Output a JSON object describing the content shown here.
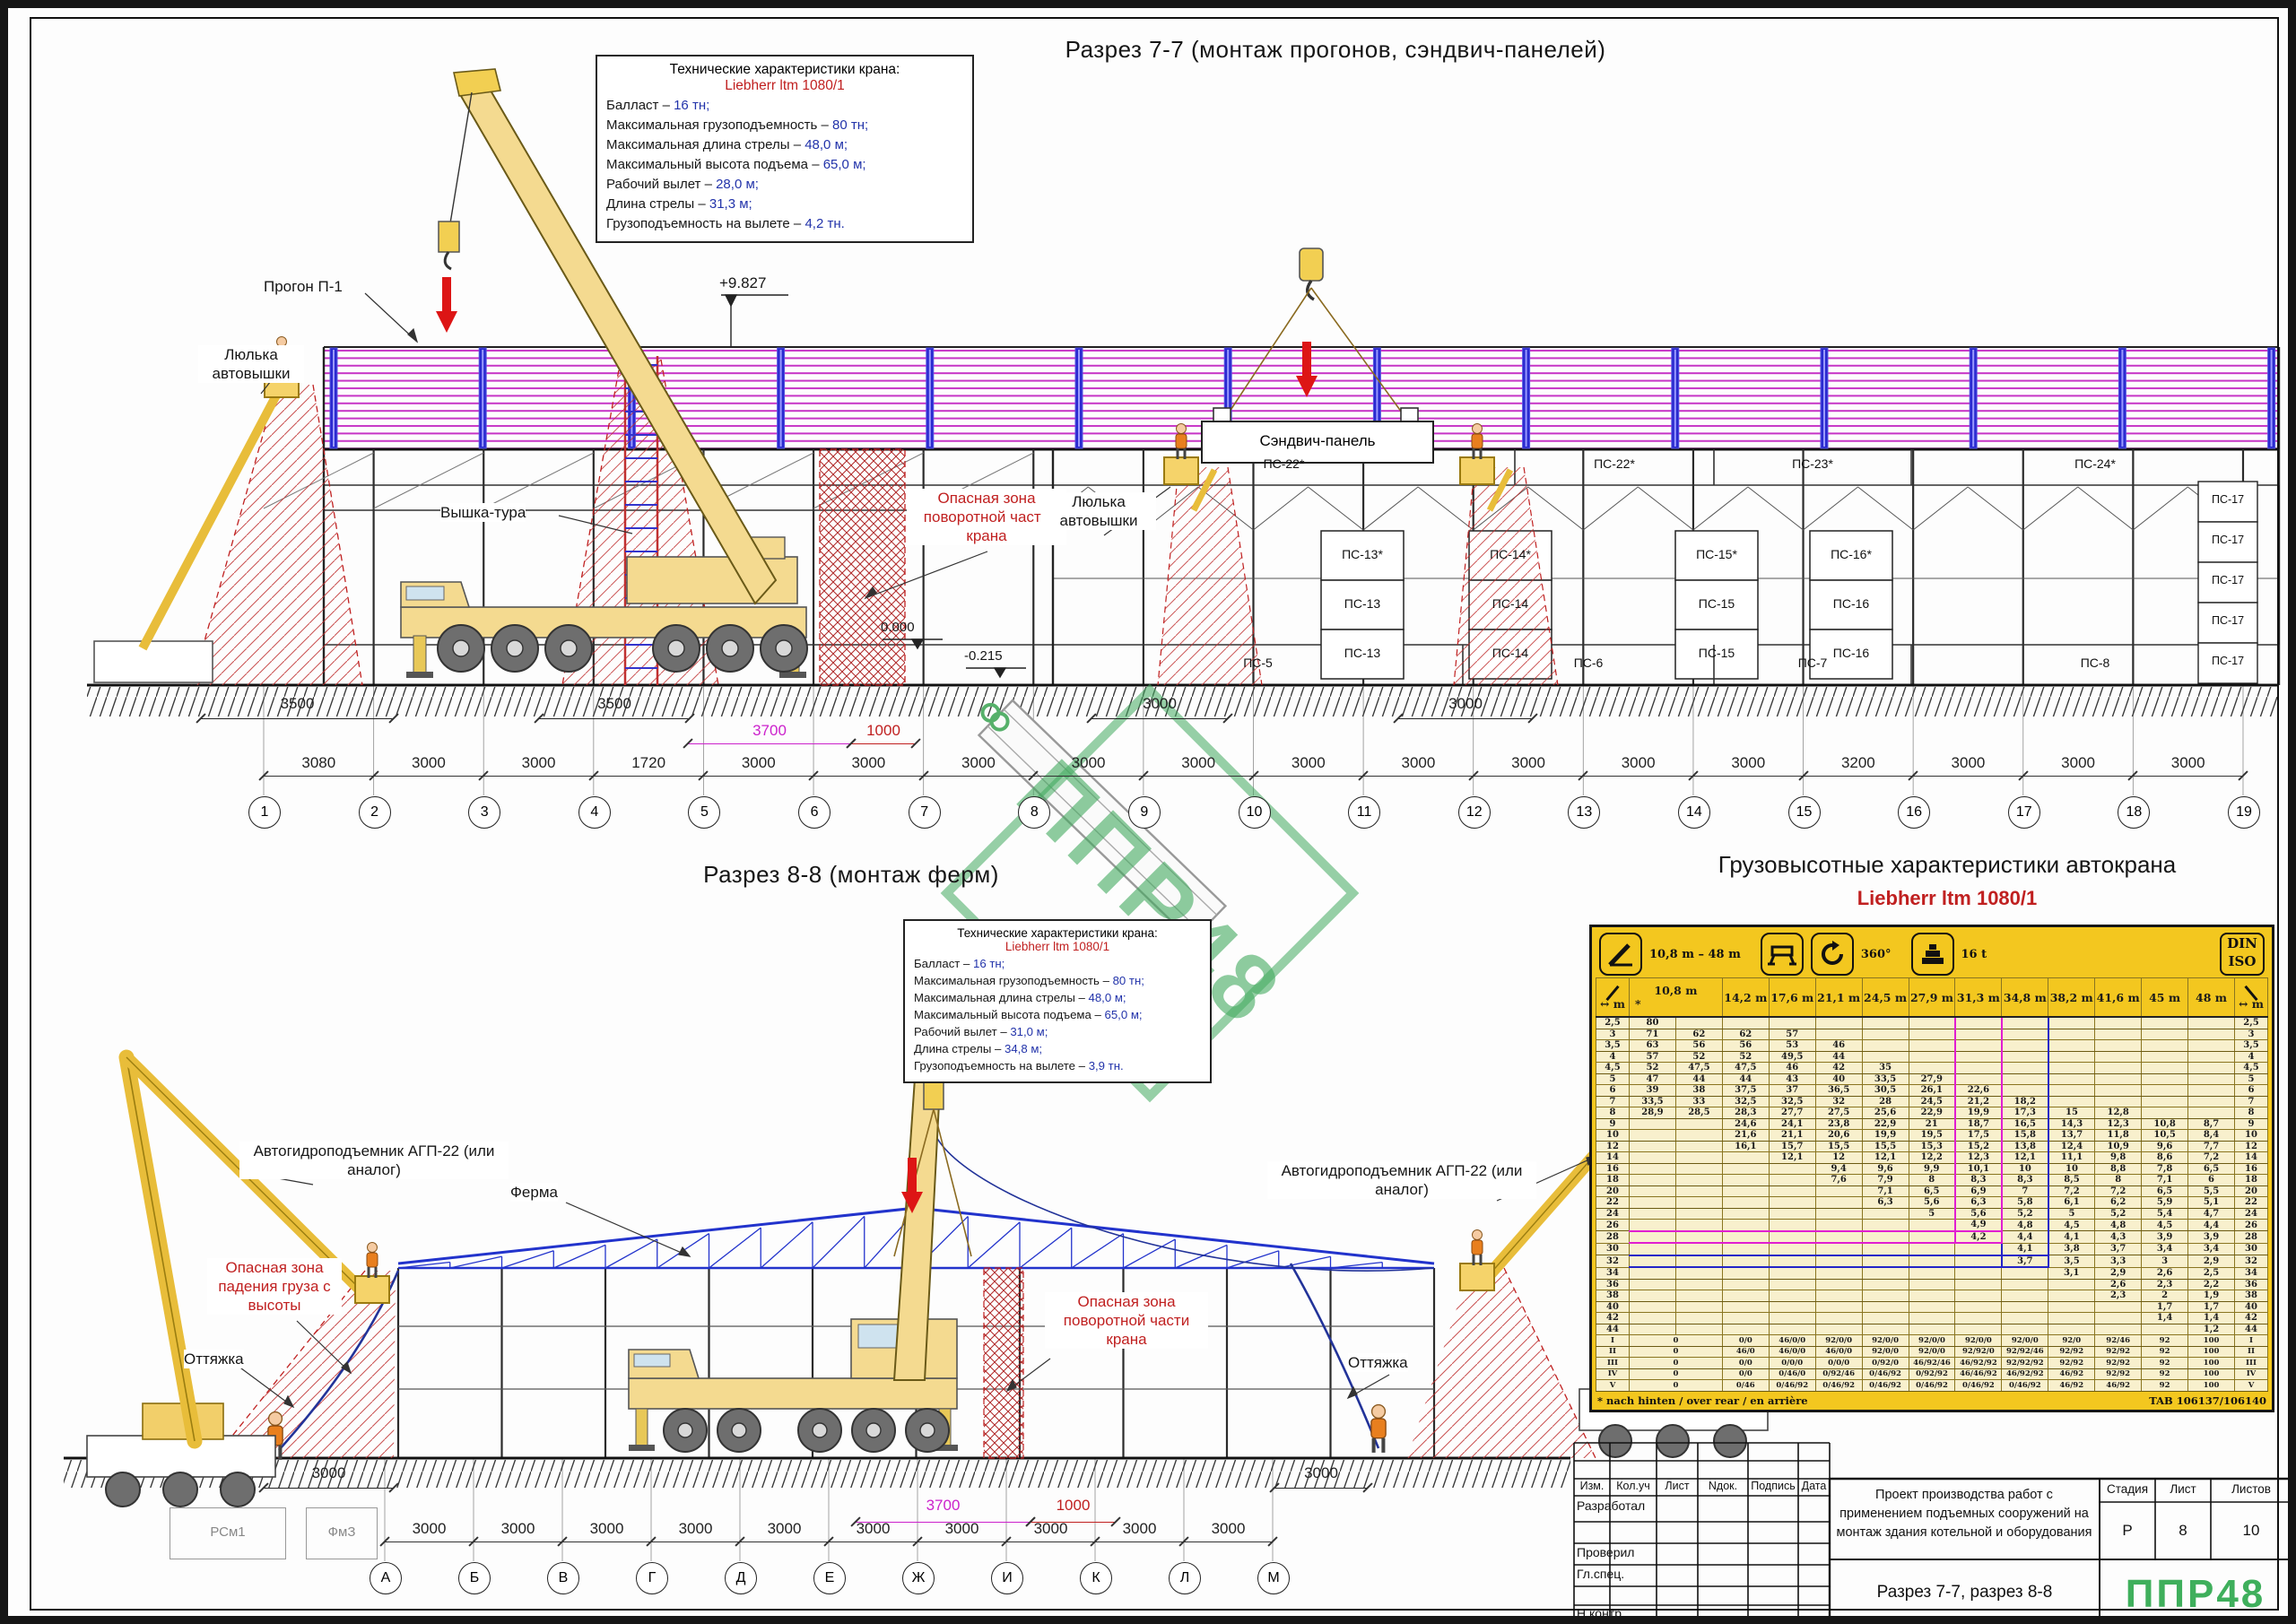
{
  "sheet": {
    "watermark": "ППР48",
    "colors": {
      "danger_red": "#c02020",
      "dim_magenta": "#cc22cc",
      "value_blue": "#2233aa",
      "panel_magenta": "#cc22cc",
      "truss_blue": "#2233cc",
      "table_yellow": "#f3c71f",
      "logo_green": "#3faf5c",
      "crane_yellow": "#f4da90"
    }
  },
  "section77": {
    "title": "Разрез 7-7 (монтаж прогонов, сэндвич-панелей)",
    "specs": {
      "heading": "Технические характеристики крана:",
      "crane_name": "Liebherr ltm 1080/1",
      "items": [
        {
          "label": "Балласт – ",
          "value": "16 тн;"
        },
        {
          "label": "Максимальная грузоподъемность – ",
          "value": "80 тн;"
        },
        {
          "label": "Максимальная длина стрелы – ",
          "value": "48,0 м;"
        },
        {
          "label": "Максимальный высота подъема – ",
          "value": "65,0 м;"
        },
        {
          "label": "Рабочий вылет – ",
          "value": "28,0 м;"
        },
        {
          "label": "Длина стрелы – ",
          "value": "31,3 м;"
        },
        {
          "label": "Грузоподъемность на вылете – ",
          "value": "4,2 тн."
        }
      ]
    },
    "labels": {
      "progon": "Прогон П-1",
      "lyulka": "Люлька автовышки",
      "vyshka": "Вышка-тура",
      "danger_crane": "Опасная зона поворотной части крана",
      "lyulka2": "Люлька автовышки",
      "sandwich": "Сэндвич-панель",
      "elev_top": "+9.827",
      "elev_zero": "0.000",
      "elev_minus": "-0.215"
    },
    "panels": {
      "top_band": [
        "ПС-22*",
        "ПС-22*",
        "ПС-23*",
        "ПС-24*"
      ],
      "stacks": [
        [
          "ПС-13*",
          "ПС-13",
          "ПС-13"
        ],
        [
          "ПС-14*",
          "ПС-14",
          "ПС-14"
        ],
        [
          "ПС-15*",
          "ПС-15",
          "ПС-15"
        ],
        [
          "ПС-16*",
          "ПС-16",
          "ПС-16"
        ]
      ],
      "bottom_band": [
        "ПС-5",
        "ПС-6",
        "ПС-7",
        "ПС-8"
      ],
      "right_stack": [
        "ПС-17",
        "ПС-17",
        "ПС-17",
        "ПС-17",
        "ПС-17"
      ]
    },
    "upper_dims": [
      {
        "text": "3500",
        "color": "#222"
      },
      {
        "text": "3500",
        "color": "#222"
      },
      {
        "text": "3700",
        "color": "#cc22cc"
      },
      {
        "text": "1000",
        "color": "#c02020"
      },
      {
        "text": "3000",
        "color": "#222"
      },
      {
        "text": "3000",
        "color": "#222"
      }
    ],
    "chain_dims": [
      "3080",
      "3000",
      "3000",
      "1720",
      "3000",
      "3000",
      "3000",
      "3000",
      "3000",
      "3000",
      "3000",
      "3000",
      "3000",
      "3000",
      "3200",
      "3000",
      "3000",
      "3000"
    ],
    "axes": [
      "1",
      "2",
      "3",
      "4",
      "5",
      "6",
      "7",
      "8",
      "9",
      "10",
      "11",
      "12",
      "13",
      "14",
      "15",
      "16",
      "17",
      "18",
      "19"
    ]
  },
  "section88": {
    "title": "Разрез 8-8 (монтаж ферм)",
    "specs": {
      "heading": "Технические характеристики крана:",
      "crane_name": "Liebherr ltm 1080/1",
      "items": [
        {
          "label": "Балласт – ",
          "value": "16 тн;"
        },
        {
          "label": "Максимальная грузоподъемность – ",
          "value": "80 тн;"
        },
        {
          "label": "Максимальная длина стрелы – ",
          "value": "48,0 м;"
        },
        {
          "label": "Максимальный высота подъема – ",
          "value": "65,0 м;"
        },
        {
          "label": "Рабочий вылет – ",
          "value": "31,0 м;"
        },
        {
          "label": "Длина стрелы – ",
          "value": "34,8 м;"
        },
        {
          "label": "Грузоподъемность на вылете – ",
          "value": "3,9 тн."
        }
      ]
    },
    "labels": {
      "agp": "Автогидроподъемник АГП-22 (или аналог)",
      "ferma": "Ферма",
      "danger_fall": "Опасная зона падения груза с высоты",
      "danger_crane": "Опасная зона поворотной части крана",
      "ottyazhka": "Оттяжка",
      "footing1": "РСм1",
      "footing2": "ФмЗ"
    },
    "ground_dims": [
      {
        "text": "3000",
        "color": "#222"
      },
      {
        "text": "3000",
        "color": "#222"
      },
      {
        "text": "3700",
        "color": "#cc22cc"
      },
      {
        "text": "1000",
        "color": "#c02020"
      }
    ],
    "chain_dims": [
      "3000",
      "3000",
      "3000",
      "3000",
      "3000",
      "3000",
      "3000",
      "3000",
      "3000",
      "3000"
    ],
    "axes": [
      "А",
      "Б",
      "В",
      "Г",
      "Д",
      "Е",
      "Ж",
      "И",
      "К",
      "Л",
      "М"
    ]
  },
  "load_chart": {
    "title": "Грузовысотные характеристики автокрана",
    "crane_name": "Liebherr ltm 1080/1",
    "badges": {
      "boom_range": "10,8 m – 48 m",
      "slew": "360°",
      "counterweight": "16 t",
      "standard": "DIN ISO"
    },
    "icons": [
      "telescopic-boom-icon",
      "outriggers-icon",
      "rotation-360-icon",
      "counterweight-icon",
      "din-iso-badge"
    ],
    "radius_unit": "m",
    "note_left": "* nach hinten / over rear / en arrière",
    "note_right": "TAB 106137/106140",
    "chart_data": {
      "type": "table",
      "boom_headers": [
        "10,8 m",
        "14,2 m",
        "17,6 m",
        "21,1 m",
        "24,5 m",
        "27,9 m",
        "31,3 m",
        "34,8 m",
        "38,2 m",
        "41,6 m",
        "45 m",
        "48 m"
      ],
      "first_header_note": "*",
      "rows": [
        {
          "radius": "2,5",
          "values": [
            "80",
            "",
            "",
            "",
            "",
            "",
            "",
            "",
            "",
            "",
            "",
            "",
            ""
          ]
        },
        {
          "radius": "3",
          "values": [
            "71",
            "62",
            "62",
            "57",
            "",
            "",
            "",
            "",
            "",
            "",
            "",
            "",
            ""
          ]
        },
        {
          "radius": "3,5",
          "values": [
            "63",
            "56",
            "56",
            "53",
            "46",
            "",
            "",
            "",
            "",
            "",
            "",
            "",
            ""
          ]
        },
        {
          "radius": "4",
          "values": [
            "57",
            "52",
            "52",
            "49,5",
            "44",
            "",
            "",
            "",
            "",
            "",
            "",
            "",
            ""
          ]
        },
        {
          "radius": "4,5",
          "values": [
            "52",
            "47,5",
            "47,5",
            "46",
            "42",
            "35",
            "",
            "",
            "",
            "",
            "",
            "",
            ""
          ]
        },
        {
          "radius": "5",
          "values": [
            "47",
            "44",
            "44",
            "43",
            "40",
            "33,5",
            "27,9",
            "",
            "",
            "",
            "",
            "",
            ""
          ]
        },
        {
          "radius": "6",
          "values": [
            "39",
            "38",
            "37,5",
            "37",
            "36,5",
            "30,5",
            "26,1",
            "22,6",
            "",
            "",
            "",
            "",
            ""
          ]
        },
        {
          "radius": "7",
          "values": [
            "33,5",
            "33",
            "32,5",
            "32,5",
            "32",
            "28",
            "24,5",
            "21,2",
            "18,2",
            "",
            "",
            "",
            ""
          ]
        },
        {
          "radius": "8",
          "values": [
            "28,9",
            "28,5",
            "28,3",
            "27,7",
            "27,5",
            "25,6",
            "22,9",
            "19,9",
            "17,3",
            "15",
            "12,8",
            "",
            ""
          ]
        },
        {
          "radius": "9",
          "values": [
            "",
            "",
            "24,6",
            "24,1",
            "23,8",
            "22,9",
            "21",
            "18,7",
            "16,5",
            "14,3",
            "12,3",
            "10,8",
            "8,7"
          ]
        },
        {
          "radius": "10",
          "values": [
            "",
            "",
            "21,6",
            "21,1",
            "20,6",
            "19,9",
            "19,5",
            "17,5",
            "15,8",
            "13,7",
            "11,8",
            "10,5",
            "8,4"
          ]
        },
        {
          "radius": "12",
          "values": [
            "",
            "",
            "16,1",
            "15,7",
            "15,5",
            "15,5",
            "15,3",
            "15,2",
            "13,8",
            "12,4",
            "10,9",
            "9,6",
            "7,7"
          ]
        },
        {
          "radius": "14",
          "values": [
            "",
            "",
            "",
            "12,1",
            "12",
            "12,1",
            "12,2",
            "12,3",
            "12,1",
            "11,1",
            "9,8",
            "8,6",
            "7,2"
          ]
        },
        {
          "radius": "16",
          "values": [
            "",
            "",
            "",
            "",
            "9,4",
            "9,6",
            "9,9",
            "10,1",
            "10",
            "10",
            "8,8",
            "7,8",
            "6,5"
          ]
        },
        {
          "radius": "18",
          "values": [
            "",
            "",
            "",
            "",
            "7,6",
            "7,9",
            "8",
            "8,3",
            "8,3",
            "8,5",
            "8",
            "7,1",
            "6"
          ]
        },
        {
          "radius": "20",
          "values": [
            "",
            "",
            "",
            "",
            "",
            "7,1",
            "6,5",
            "6,9",
            "7",
            "7,2",
            "7,2",
            "6,5",
            "5,5"
          ]
        },
        {
          "radius": "22",
          "values": [
            "",
            "",
            "",
            "",
            "",
            "6,3",
            "5,6",
            "6,3",
            "5,8",
            "6,1",
            "6,2",
            "5,9",
            "5,1"
          ]
        },
        {
          "radius": "24",
          "values": [
            "",
            "",
            "",
            "",
            "",
            "",
            "5",
            "5,6",
            "5,2",
            "5",
            "5,2",
            "5,4",
            "4,7"
          ]
        },
        {
          "radius": "26",
          "values": [
            "",
            "",
            "",
            "",
            "",
            "",
            "",
            "4,9",
            "4,8",
            "4,5",
            "4,8",
            "4,5",
            "4,4"
          ]
        },
        {
          "radius": "28",
          "values": [
            "",
            "",
            "",
            "",
            "",
            "",
            "",
            "4,2",
            "4,4",
            "4,1",
            "4,3",
            "3,9",
            "3,9"
          ]
        },
        {
          "radius": "30",
          "values": [
            "",
            "",
            "",
            "",
            "",
            "",
            "",
            "",
            "4,1",
            "3,8",
            "3,7",
            "3,4",
            "3,4"
          ]
        },
        {
          "radius": "32",
          "values": [
            "",
            "",
            "",
            "",
            "",
            "",
            "",
            "",
            "3,7",
            "3,5",
            "3,3",
            "3",
            "2,9"
          ]
        },
        {
          "radius": "34",
          "values": [
            "",
            "",
            "",
            "",
            "",
            "",
            "",
            "",
            "",
            "3,1",
            "2,9",
            "2,6",
            "2,5"
          ]
        },
        {
          "radius": "36",
          "values": [
            "",
            "",
            "",
            "",
            "",
            "",
            "",
            "",
            "",
            "",
            "2,6",
            "2,3",
            "2,2"
          ]
        },
        {
          "radius": "38",
          "values": [
            "",
            "",
            "",
            "",
            "",
            "",
            "",
            "",
            "",
            "",
            "2,3",
            "2",
            "1,9"
          ]
        },
        {
          "radius": "40",
          "values": [
            "",
            "",
            "",
            "",
            "",
            "",
            "",
            "",
            "",
            "",
            "",
            "1,7",
            "1,7"
          ]
        },
        {
          "radius": "42",
          "values": [
            "",
            "",
            "",
            "",
            "",
            "",
            "",
            "",
            "",
            "",
            "",
            "1,4",
            "1,4"
          ]
        },
        {
          "radius": "44",
          "values": [
            "",
            "",
            "",
            "",
            "",
            "",
            "",
            "",
            "",
            "",
            "",
            "",
            "1,2"
          ]
        }
      ],
      "footer_rows": [
        {
          "label": "I",
          "values": [
            "0",
            "0/0",
            "46/0/0",
            "92/0/0",
            "92/0/0",
            "92/0/0",
            "92/0/0",
            "92/0/0",
            "92/0",
            "92/46",
            "92",
            "100"
          ]
        },
        {
          "label": "II",
          "values": [
            "0",
            "46/0",
            "46/0/0",
            "46/0/0",
            "92/0/0",
            "92/0/0",
            "92/92/0",
            "92/92/46",
            "92/92",
            "92/92",
            "92",
            "100"
          ]
        },
        {
          "label": "III",
          "values": [
            "0",
            "0/0",
            "0/0/0",
            "0/0/0",
            "0/92/0",
            "46/92/46",
            "46/92/92",
            "92/92/92",
            "92/92",
            "92/92",
            "92",
            "100"
          ]
        },
        {
          "label": "IV",
          "values": [
            "0",
            "0/0",
            "0/46/0",
            "0/92/46",
            "0/46/92",
            "0/92/92",
            "46/46/92",
            "46/92/92",
            "46/92",
            "92/92",
            "92",
            "100"
          ]
        },
        {
          "label": "V",
          "values": [
            "0",
            "0/46",
            "0/46/92",
            "0/46/92",
            "0/46/92",
            "0/46/92",
            "0/46/92",
            "0/46/92",
            "46/92",
            "46/92",
            "92",
            "100"
          ]
        }
      ],
      "highlight": {
        "magenta": {
          "boom": "31,3 m",
          "radius": "28"
        },
        "blue": {
          "boom": "34,8 m",
          "radius": "32"
        }
      }
    }
  },
  "titleblock": {
    "columns": [
      "Изм.",
      "Кол.уч",
      "Лист",
      "Nдок.",
      "Подпись",
      "Дата"
    ],
    "roles": [
      "Разработал",
      "Проверил",
      "Гл.спец.",
      "Н.контр."
    ],
    "project": "Проект производства работ с применением подъемных сооружений на монтаж здания котельной и оборудования",
    "doc_title": "Разрез 7-7, разрез 8-8",
    "stage_label": "Стадия",
    "sheet_label": "Лист",
    "sheets_label": "Листов",
    "stage": "Р",
    "sheet": "8",
    "sheets": "10",
    "logo": "ППР48"
  }
}
